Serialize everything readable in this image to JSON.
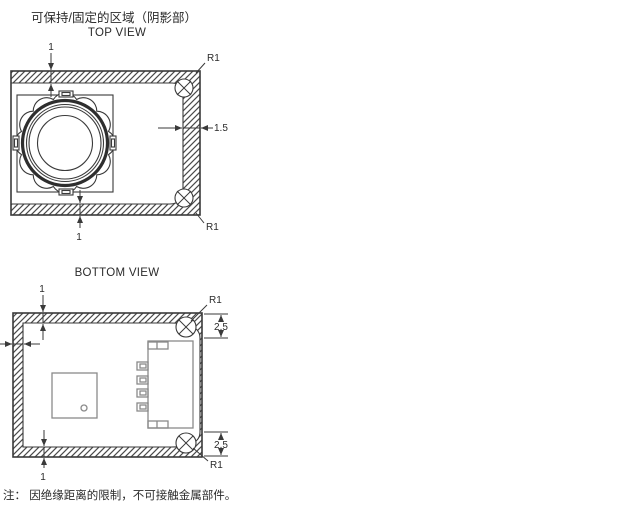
{
  "titles": {
    "shaded_area": "可保持/固定的区域（阴影部）",
    "top_view": "TOP VIEW",
    "bottom_view": "BOTTOM VIEW"
  },
  "note": "注： 因绝缘距离的限制，不可接触金属部件。",
  "dimensions": {
    "top_view": {
      "top_edge_thickness": "1",
      "bottom_edge_thickness": "1",
      "right_band_width": "1.5",
      "corner_radius_top": "R1",
      "corner_radius_bottom": "R1"
    },
    "bottom_view": {
      "top_edge_thickness": "1",
      "bottom_edge_thickness": "1",
      "corner_radius_top": "R1",
      "corner_radius_bottom": "R1",
      "corner_region_top": "2.5",
      "corner_region_bottom": "2.5"
    }
  },
  "colors": {
    "line": "#3a3a3a",
    "component": "#8a8a8a",
    "hatch": "#4a4a4a",
    "background": "#ffffff",
    "text": "#2b2b2b"
  }
}
